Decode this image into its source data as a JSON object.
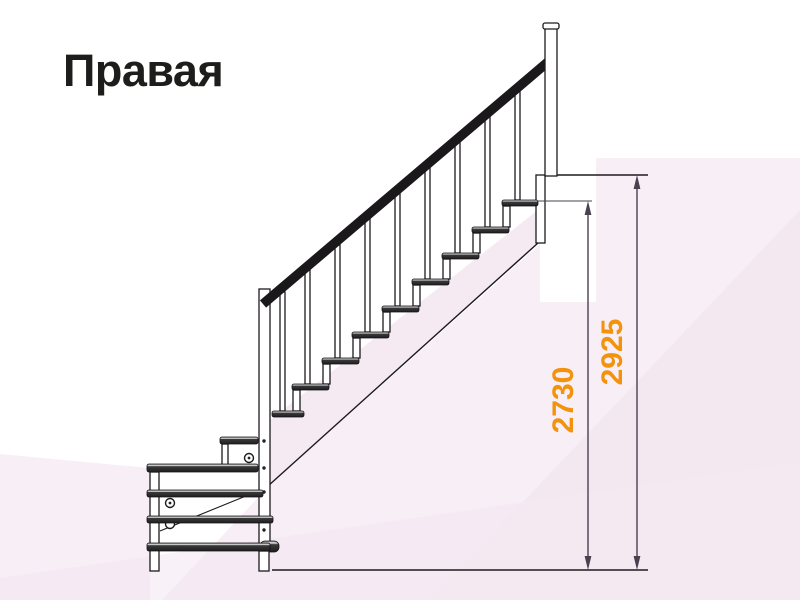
{
  "page": {
    "title": "Правая"
  },
  "diagram": {
    "name": "staircase-side-view",
    "dimensions": [
      {
        "id": "inner-height",
        "value": "2730"
      },
      {
        "id": "total-height",
        "value": "2925"
      }
    ],
    "accent_color": "#F2920D",
    "line_color": "#1D1A1D",
    "dimension_line_color": "#4A4050",
    "background_tint": "#F8EEF5"
  }
}
